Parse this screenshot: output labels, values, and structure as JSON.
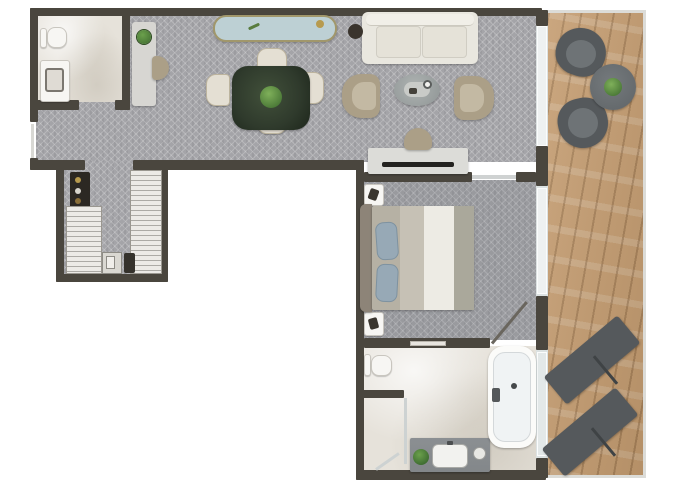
{
  "meta": {
    "kind": "architectural floor plan",
    "view": "top-down",
    "subject": "hotel-suite / apartment floor plan with L-shaped interior and side terrace",
    "visible_text": "none"
  },
  "colors": {
    "background": "#ffffff",
    "wall": "#4a463e",
    "carpet": "#a4a4a8",
    "marble": "#e6e2da",
    "wood": "#c49c70",
    "glass": "#dce2e2",
    "railing": "#dcdcd8",
    "fixture": "#f7f6f3",
    "sofa": "#e9e7df",
    "armchair": "#ab9f87",
    "chair-cream": "#e4dfd3",
    "dining-table": "#2f3a2c",
    "plant": "#4c7a38",
    "bench-cushion": "#bdd0d4",
    "bench-frame": "#a1976b",
    "bed-blanket": "#b6b1a4",
    "bed-runner": "#edebe4",
    "pillow": "#97a9b6",
    "headboard": "#8d8478",
    "outdoor": "#55595c",
    "vanity-counter": "#83878a",
    "wardrobe": "#eceae6",
    "minibar": "#2c2823"
  },
  "floor_plan": {
    "rooms": [
      {
        "name": "living-dining-area",
        "floor": "patterned carpet",
        "position": "top band"
      },
      {
        "name": "guest-bathroom",
        "floor": "marble",
        "position": "top-left"
      },
      {
        "name": "walk-in-closet",
        "floor": "patterned carpet",
        "position": "left, below living band"
      },
      {
        "name": "bedroom",
        "floor": "patterned carpet",
        "position": "right-middle"
      },
      {
        "name": "main-bathroom",
        "floor": "marble",
        "position": "bottom-right"
      },
      {
        "name": "terrace",
        "floor": "wood deck",
        "position": "right edge, full height"
      }
    ],
    "furniture": {
      "guest_bathroom": [
        "toilet",
        "vanity-with-sink"
      ],
      "living_dining": [
        "console-with-plant",
        "console-chair",
        "upholstered-bench",
        "dining-table-with-centerpiece",
        "dining-chair x4",
        "sofa",
        "round-side-table",
        "armchair x2",
        "oval-coffee-table-with-tray",
        "desk-with-tv",
        "desk-chair"
      ],
      "walk_in_closet": [
        "minibar-shelf",
        "wardrobe-left",
        "wardrobe-right",
        "safe",
        "luggage-case"
      ],
      "bedroom": [
        "double-bed-with-pillows",
        "headboard",
        "nightstand x2",
        "door-to-bathroom"
      ],
      "main_bathroom": [
        "toilet",
        "shower-enclosure",
        "vanity-with-sink-and-plant",
        "bathtub"
      ],
      "terrace": [
        "round-lounge-chair x2",
        "round-side-table-with-plant",
        "sun-lounger x2",
        "glass-sliding-doors",
        "railing"
      ]
    }
  }
}
